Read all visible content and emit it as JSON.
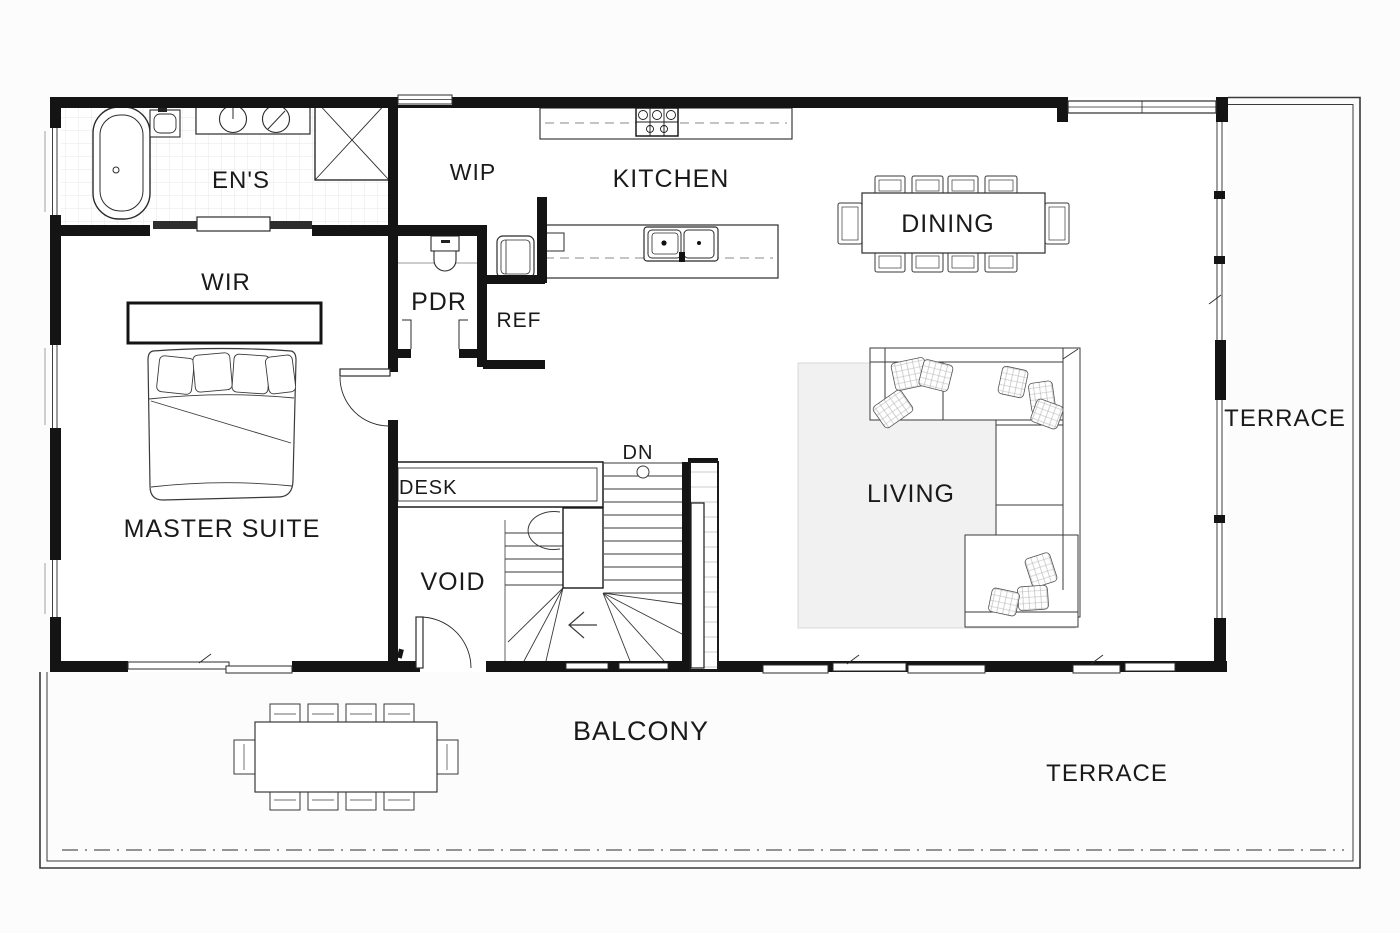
{
  "plan": {
    "title": "first-floor-plan",
    "rooms": {
      "ens": {
        "label": "EN'S"
      },
      "wir": {
        "label": "WIR"
      },
      "master": {
        "label": "MASTER SUITE"
      },
      "wip": {
        "label": "WIP"
      },
      "pdr": {
        "label": "PDR"
      },
      "ref": {
        "label": "REF"
      },
      "kitchen": {
        "label": "KITCHEN"
      },
      "dining": {
        "label": "DINING"
      },
      "living": {
        "label": "LIVING"
      },
      "void": {
        "label": "VOID"
      },
      "desk": {
        "label": "DESK"
      },
      "balcony": {
        "label": "BALCONY"
      },
      "terrace_right": {
        "label": "TERRACE"
      },
      "terrace_bottom": {
        "label": "TERRACE"
      }
    },
    "stairs": {
      "dn_label": "DN"
    },
    "fixtures": [
      "bathtub-icon",
      "shower-icon",
      "double-vanity-icon",
      "toilet-icon",
      "cavity-slider-door",
      "bed-icon",
      "wardrobe-shelf",
      "powder-toilet-icon",
      "fridge-icon",
      "cooktop-icon",
      "island-sink-icon",
      "dining-table-10-seats",
      "sectional-sofa-icon",
      "outdoor-table-10-seats",
      "stair-run-down",
      "desk-icon"
    ],
    "colors": {
      "wall": "#141414",
      "text": "#1a1a1a",
      "line": "#2b2b2b",
      "rug": "#f1f1f1",
      "tile": "#e7e7e7",
      "background": "#fcfcfc"
    }
  }
}
